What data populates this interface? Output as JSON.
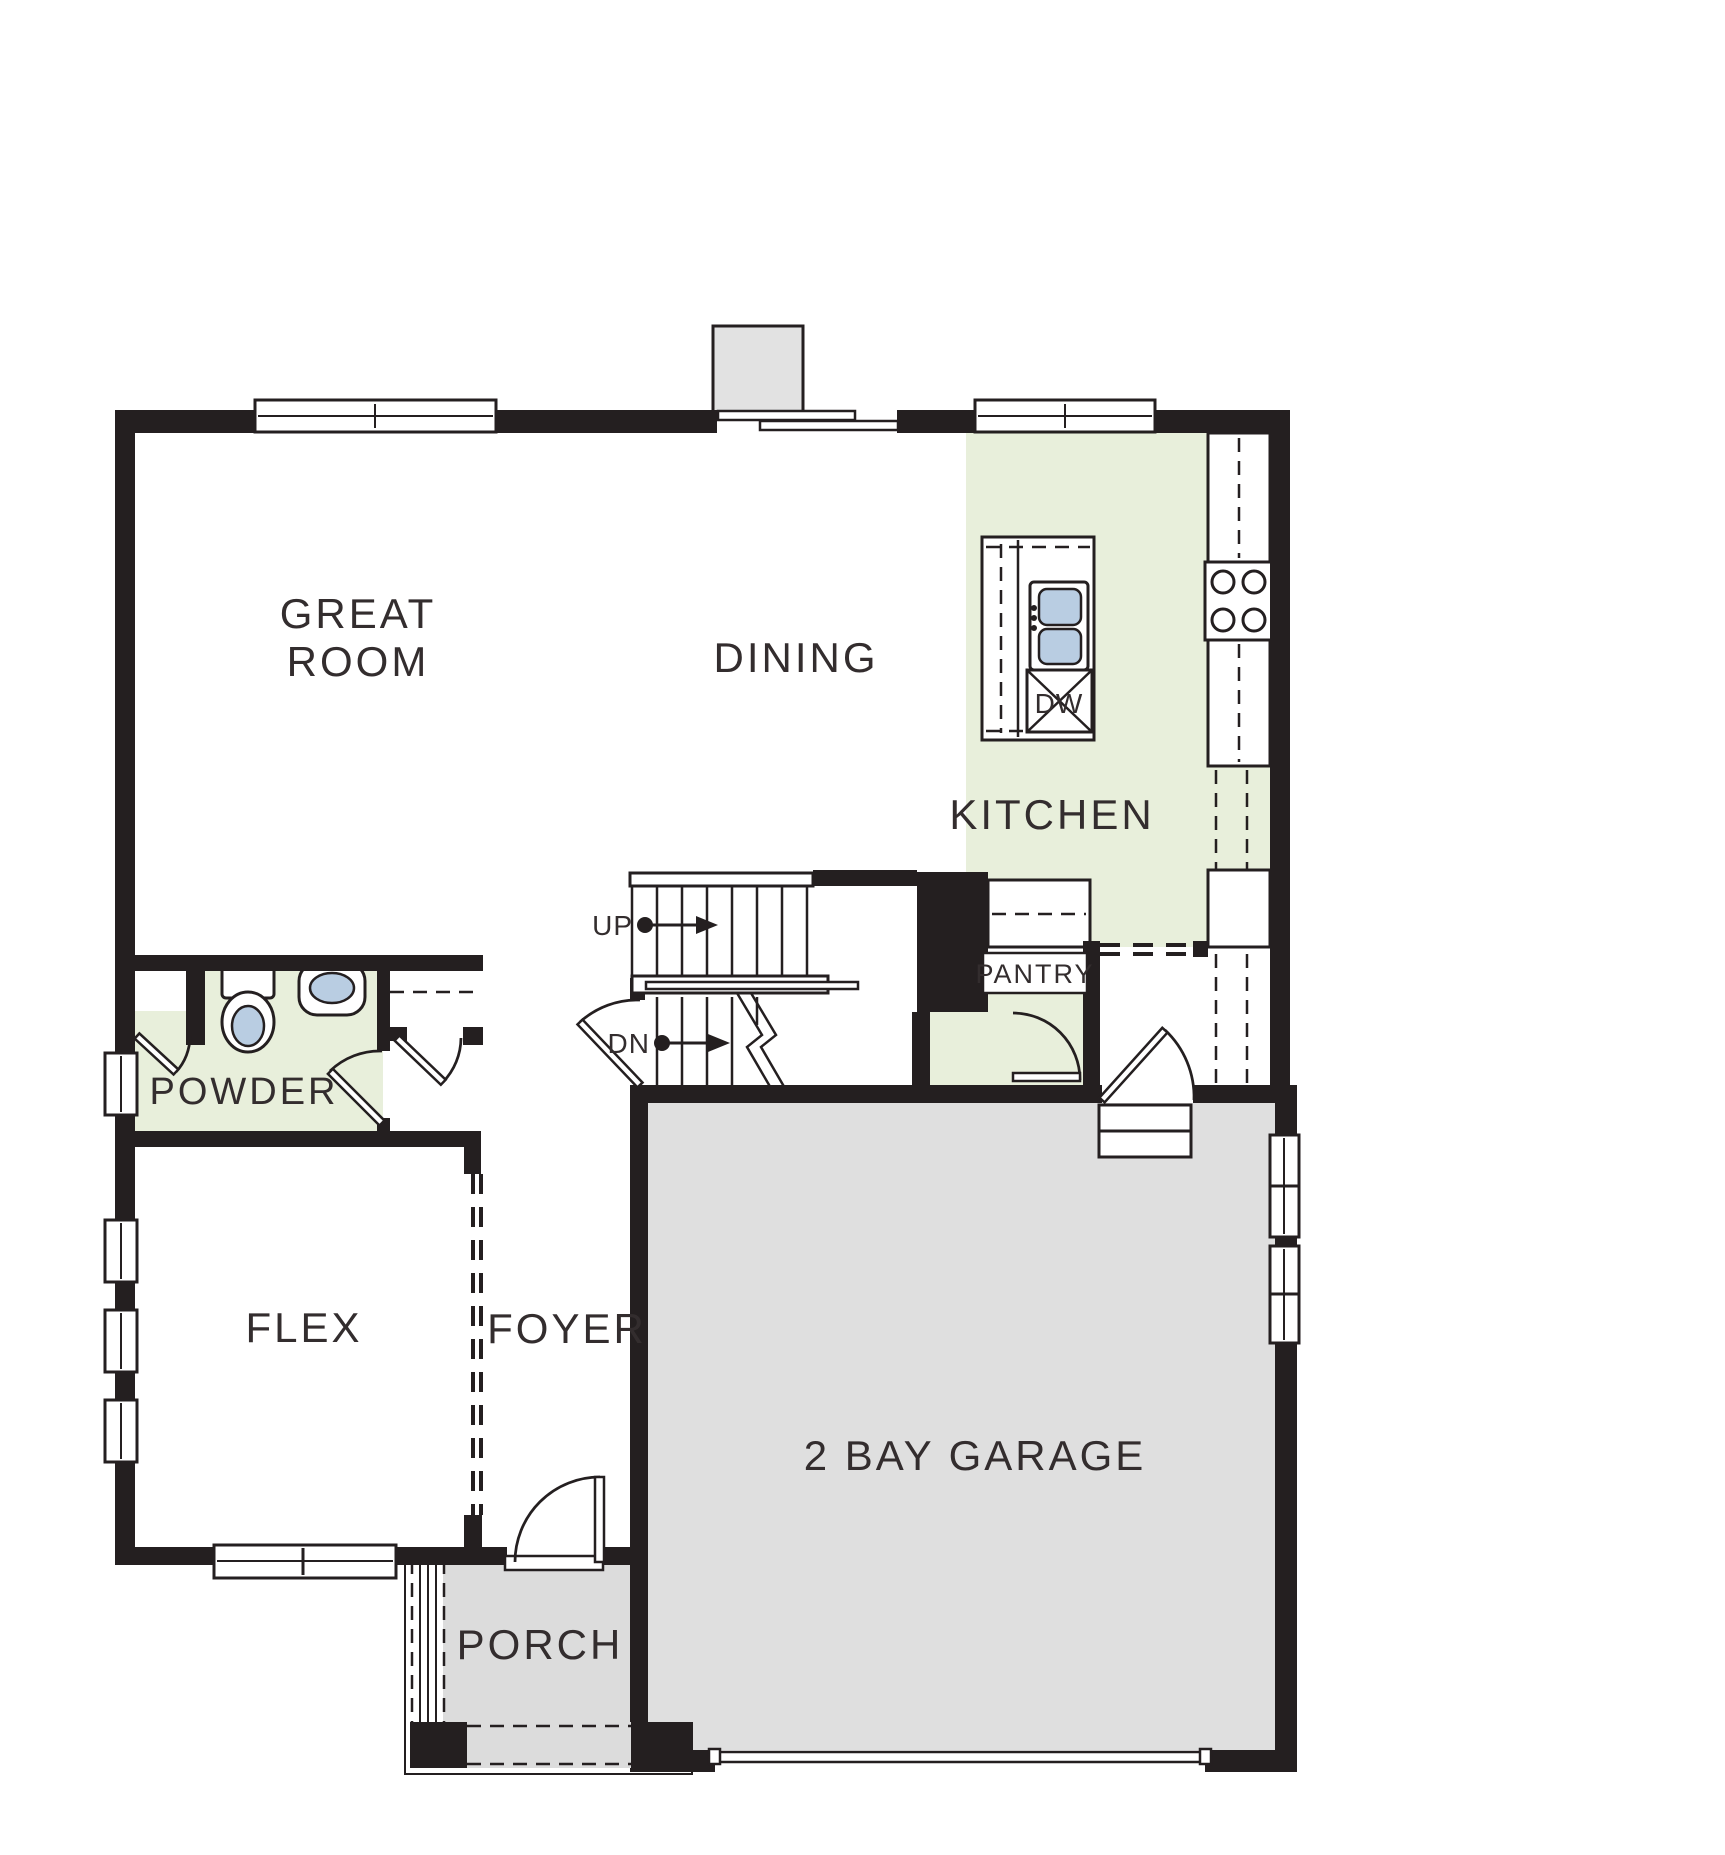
{
  "colors": {
    "background": "#ffffff",
    "wall": "#241f20",
    "line": "#241f20",
    "room_green": "#e8efdb",
    "garage_gray": "#dfdfdf",
    "porch_gray": "#dcdcdc",
    "chimney_gray": "#e2e2e2",
    "fixture_blue": "#b9cde2",
    "label_color": "#332d2e"
  },
  "rooms": {
    "great_room": {
      "line1": "GREAT",
      "line2": "ROOM"
    },
    "dining": {
      "label": "DINING"
    },
    "kitchen": {
      "label": "KITCHEN"
    },
    "pantry": {
      "label": "PANTRY"
    },
    "powder": {
      "label": "POWDER"
    },
    "flex": {
      "label": "FLEX"
    },
    "foyer": {
      "label": "FOYER"
    },
    "garage": {
      "label": "2 BAY GARAGE"
    },
    "porch": {
      "label": "PORCH"
    }
  },
  "stairs": {
    "up": "UP",
    "down": "DN"
  },
  "appliances": {
    "dishwasher": "DW"
  }
}
